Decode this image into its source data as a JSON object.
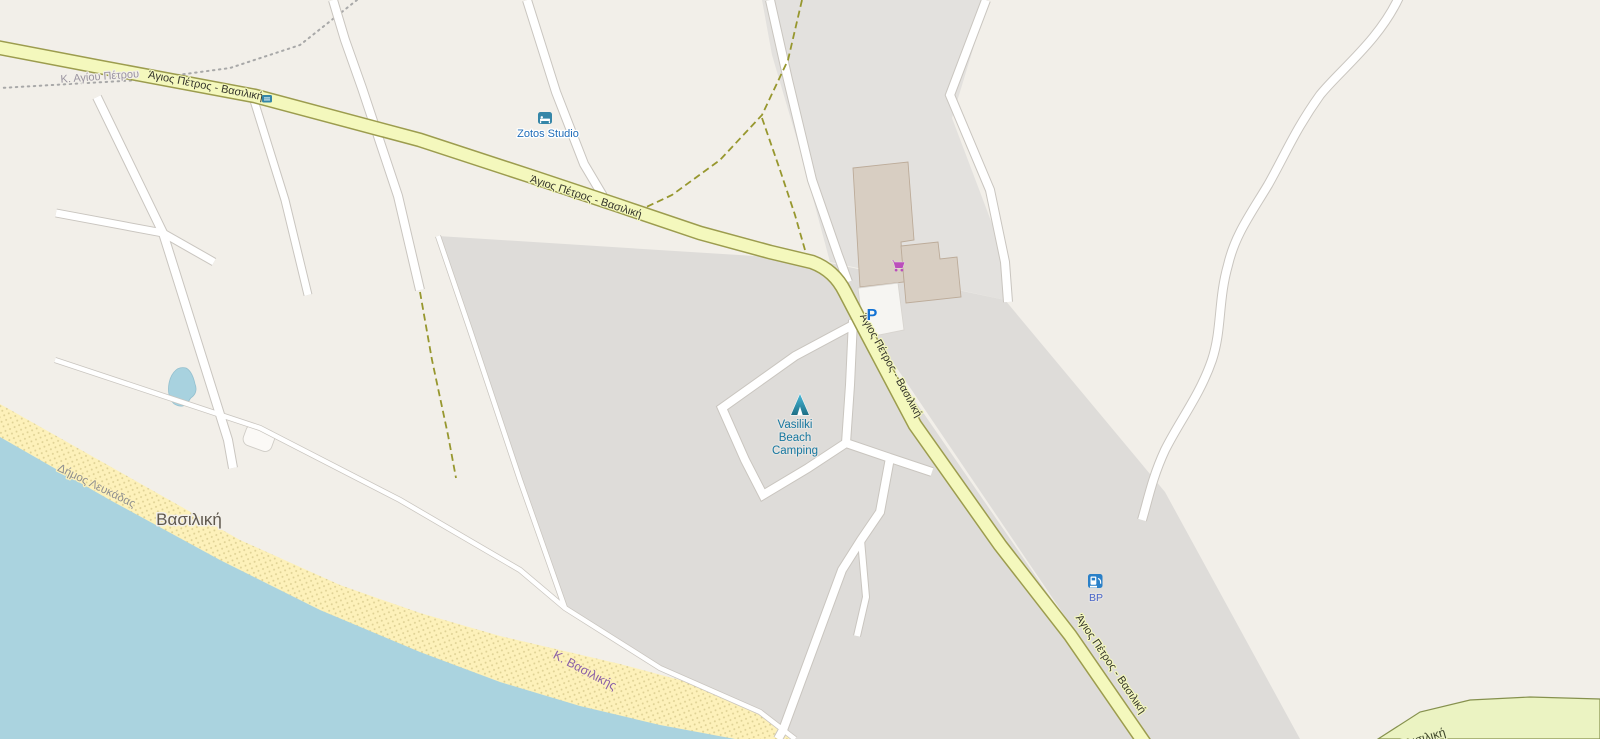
{
  "map_labels": {
    "main_road": "Άγιος Πέτρος - Βασιλική",
    "boundary_agiou_petrou": "Κ. Αγίου Πέτρου",
    "boundary_vasilikis": "Κ. Βασιλικής",
    "municipality": "Δήμος Λευκάδας",
    "place_vasiliki": "Βασιλική",
    "road_bottom_right": "Βασιλική"
  },
  "pois": {
    "zotos_studio": {
      "label": "Zotos Studio",
      "icon": "bed-icon"
    },
    "vasiliki_beach_camping": {
      "line1": "Vasiliki",
      "line2": "Beach",
      "line3": "Camping",
      "icon": "tent-icon"
    },
    "bp_fuel_station": {
      "label": "BP",
      "icon": "fuel-pump-icon"
    },
    "parking": {
      "label": "P",
      "icon": "parking-icon"
    },
    "supermarket": {
      "icon": "shopping-cart-icon"
    }
  },
  "colors": {
    "land": "#f2efe9",
    "urban_area": "#dedcd9",
    "water": "#aad3df",
    "beach": "#fdf1ba",
    "beach_dot": "#ddd093",
    "main_road_fill": "#f4f8bd",
    "main_road_casing": "#9c9c4e",
    "minor_road_fill": "#ffffff",
    "minor_road_casing": "#c9c5bf",
    "building": "#d8cec2",
    "building_outline": "#bcab99",
    "track_dash": "#97972e",
    "boundary_dot": "#a8a8a8",
    "hotel_icon": "#3586a8",
    "camping_icon_dark": "#1c6f86",
    "camping_icon_light": "#49b8d8",
    "supermarket_icon": "#bb4fbb",
    "parking_icon": "#1272d4",
    "fuel_icon": "#2a80c8"
  }
}
